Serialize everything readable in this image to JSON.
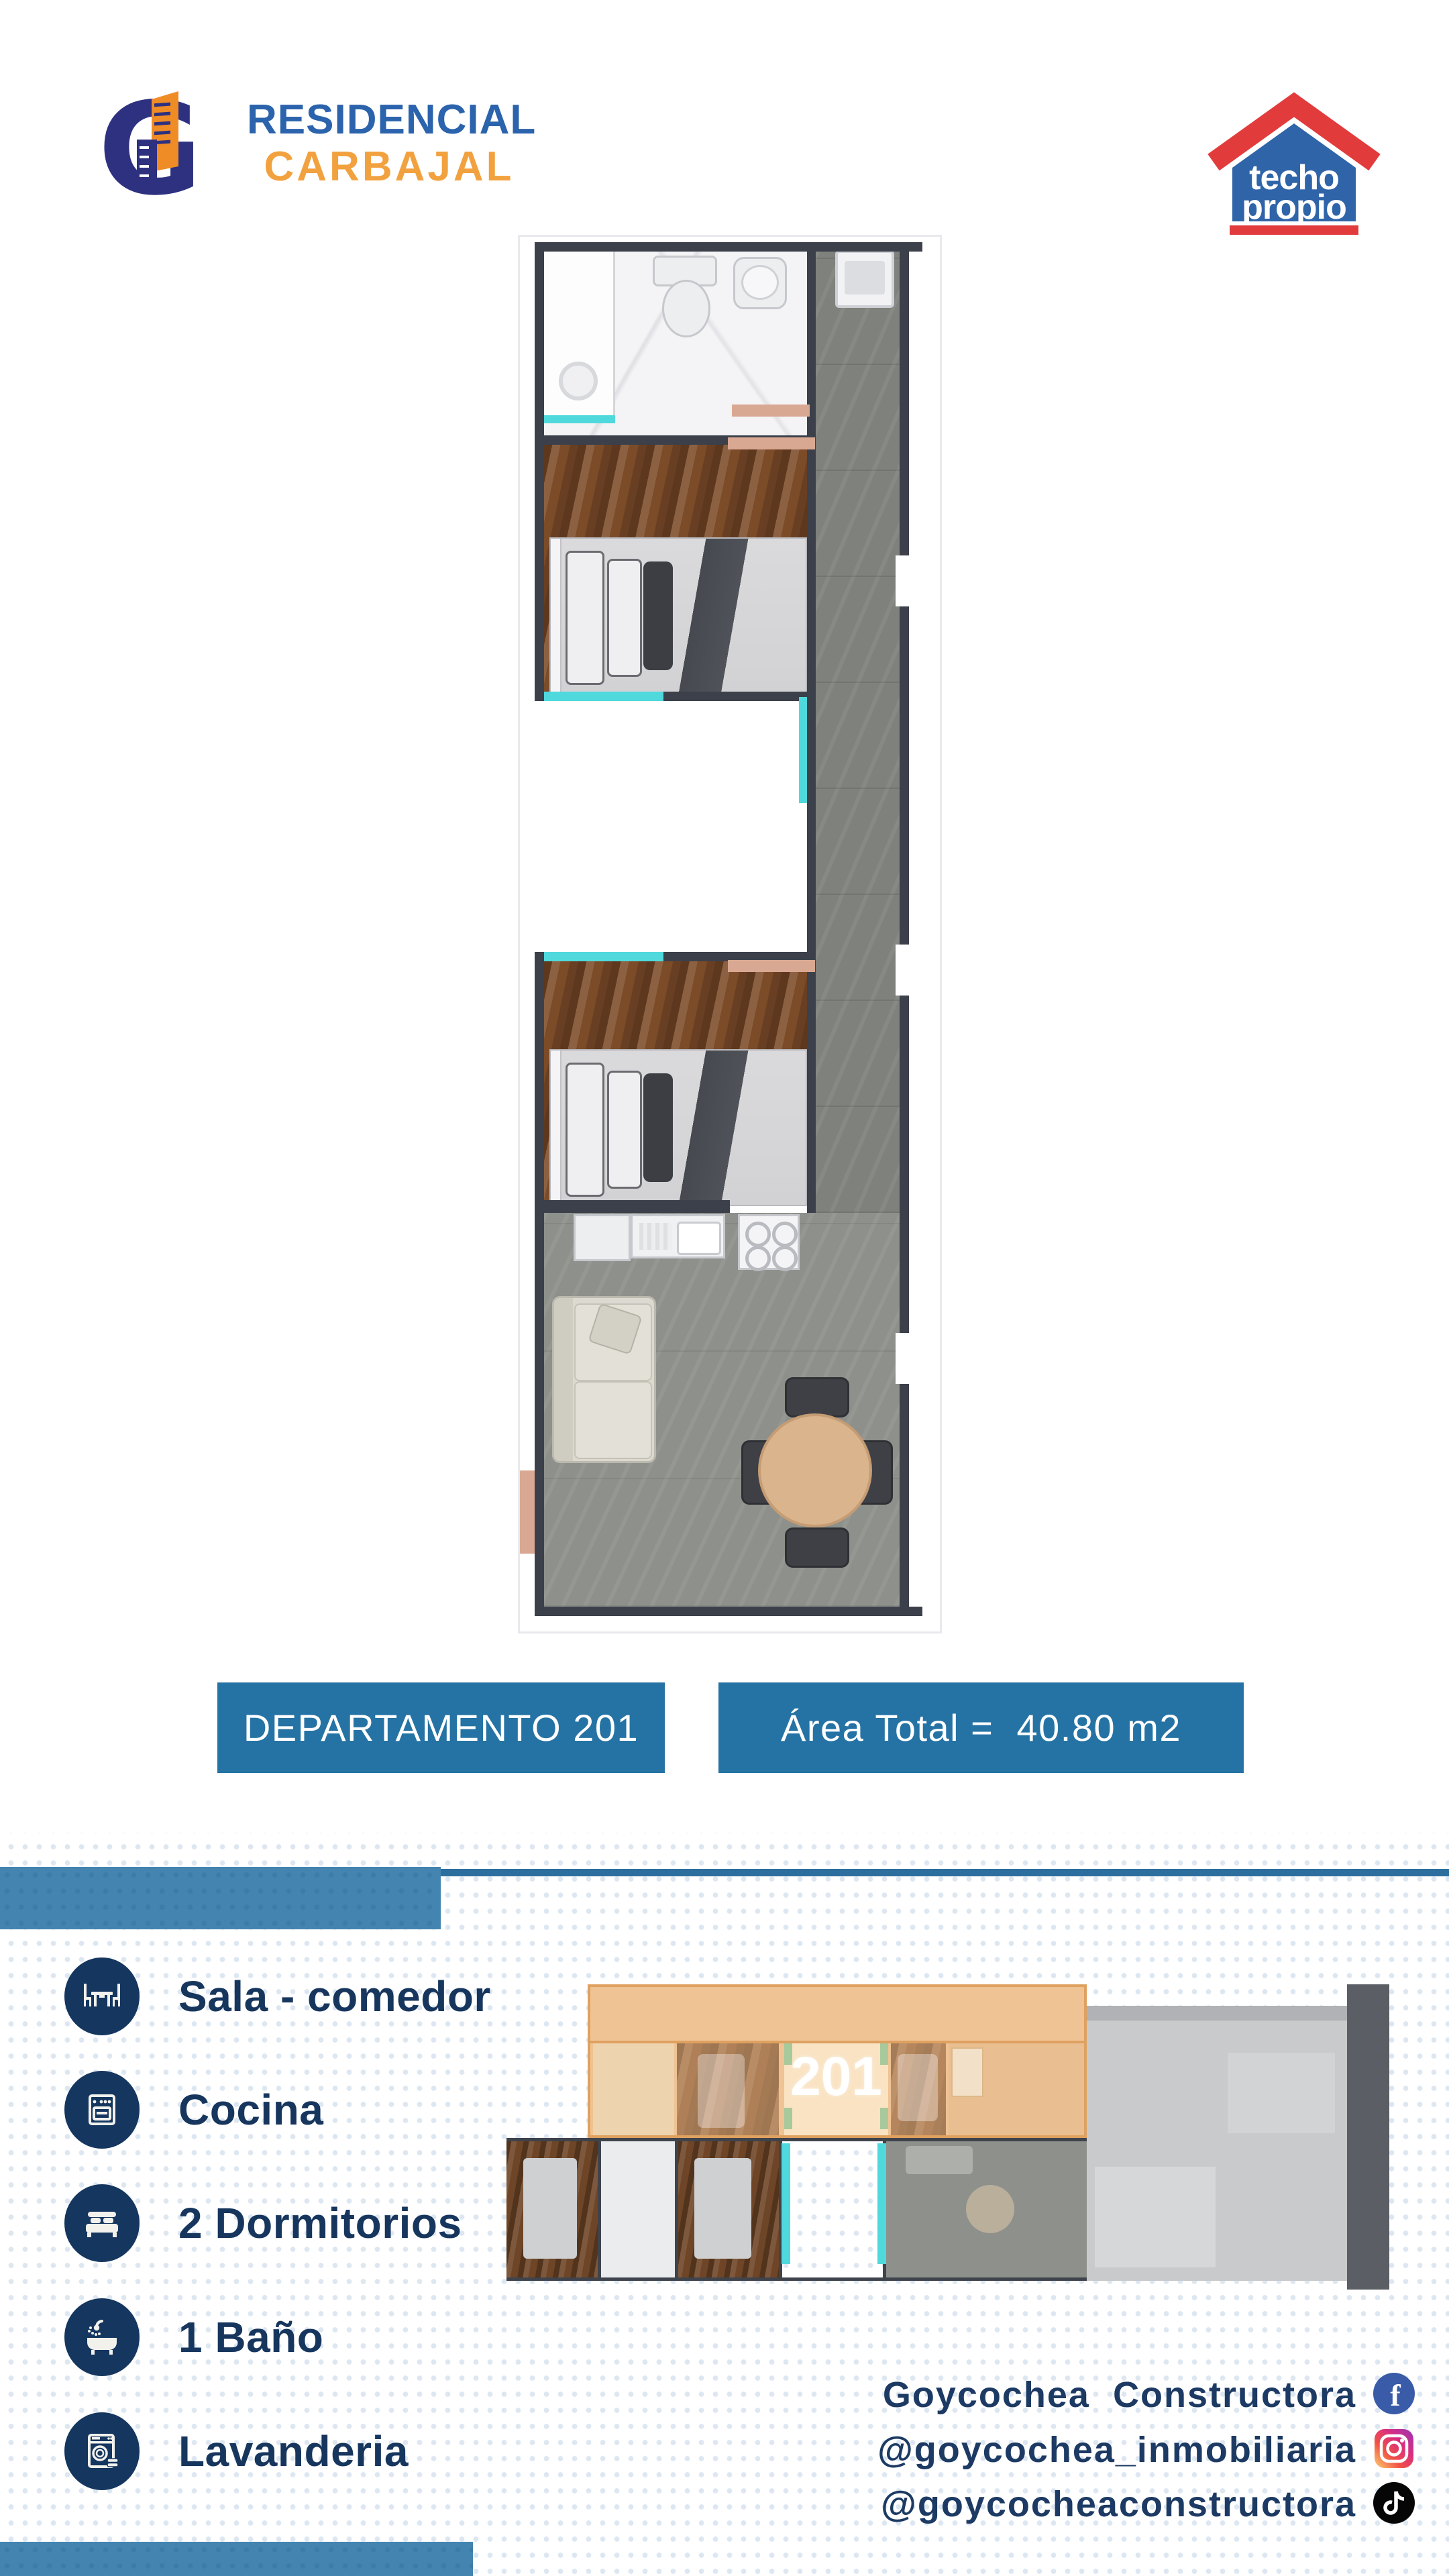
{
  "brand": {
    "g_letter": "G",
    "name_line1": "RESIDENCIAL",
    "name_line2": "CARBAJAL"
  },
  "techo_propio": {
    "line1": "techo",
    "line2": "propio"
  },
  "banners": {
    "unit": "DEPARTAMENTO 201",
    "area": "Área Total =  40.80 m2"
  },
  "level_plan": {
    "unit_number": "201"
  },
  "amenities": {
    "items": [
      {
        "icon": "dining-icon",
        "label": "Sala - comedor"
      },
      {
        "icon": "stove-icon",
        "label": "Cocina"
      },
      {
        "icon": "bed-icon",
        "label": "2 Dormitorios"
      },
      {
        "icon": "bath-icon",
        "label": "1 Baño"
      },
      {
        "icon": "washer-icon",
        "label": "Lavanderia"
      }
    ]
  },
  "social": {
    "items": [
      {
        "network": "facebook",
        "icon": "facebook-icon",
        "handle": "Goycochea  Constructora"
      },
      {
        "network": "instagram",
        "icon": "instagram-icon",
        "handle": "@goycochea_inmobiliaria"
      },
      {
        "network": "tiktok",
        "icon": "tiktok-icon",
        "handle": "@goycocheaconstructora"
      }
    ]
  },
  "colors": {
    "banner_blue": "#2573a4",
    "divider_blue": "#4384b1",
    "divider_bar_blue": "#2c6f9e",
    "navy": "#14365f",
    "logo_blue": "#2b63ac",
    "logo_orange": "#f2a13f",
    "techo_red": "#e23b3c",
    "techo_blue": "#2f64a9",
    "highlight_orange": "#efc393",
    "window_cyan": "#4fd9dd",
    "dot_blue": "#dde7f1",
    "wall_dark": "#3b404b"
  }
}
